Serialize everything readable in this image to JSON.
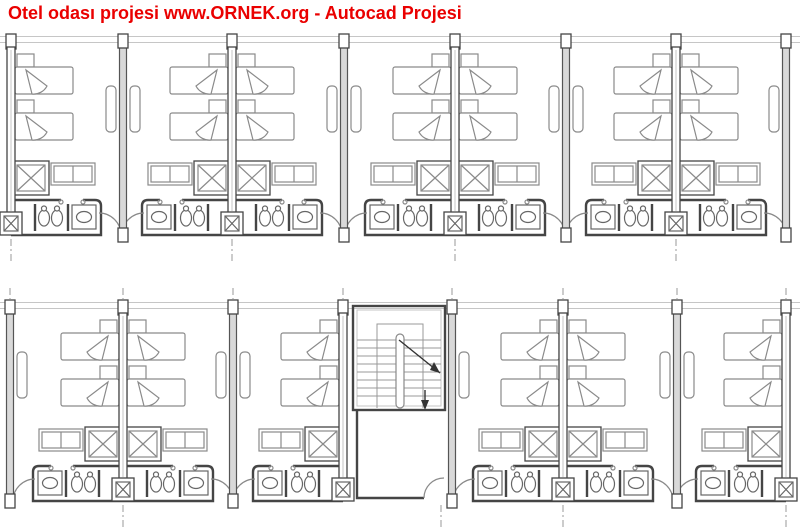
{
  "page": {
    "title": "Otel odası projesi www.ORNEK.org - Autocad Projesi",
    "background": "#ffffff"
  },
  "colors": {
    "title_red": "#ea0000",
    "wall_dark": "#454545",
    "furniture_gray": "#8a8a8a",
    "fixture_gray": "#666666",
    "light_gray": "#c6c6c6",
    "partition_fill": "#d9d9d9",
    "centerline_gray": "#9a9a9a",
    "stair_detail": "#999999"
  },
  "floorplan": {
    "drawing_type": "hotel-guestroom-floor-plan",
    "canvas": {
      "width": 800,
      "height": 532
    },
    "rows": [
      {
        "name": "upper-wing",
        "y": 42,
        "pairs": [
          {
            "x": 11,
            "rooms": [
              "right"
            ]
          },
          {
            "x": 232,
            "rooms": [
              "left",
              "right"
            ]
          },
          {
            "x": 455,
            "rooms": [
              "left",
              "right"
            ]
          },
          {
            "x": 676,
            "rooms": [
              "left",
              "right"
            ]
          }
        ],
        "partitions": [
          {
            "x": 123,
            "desks": [
              "left",
              "right"
            ]
          },
          {
            "x": 344,
            "desks": [
              "left",
              "right"
            ]
          },
          {
            "x": 566,
            "desks": [
              "left",
              "right"
            ]
          },
          {
            "x": 786,
            "desks": [
              "left"
            ]
          }
        ],
        "centerlines_above": [],
        "centerlines_below": [
          11,
          232,
          455,
          676
        ]
      },
      {
        "name": "lower-wing",
        "y": 308,
        "pairs": [
          {
            "x": 123,
            "rooms": [
              "left",
              "right"
            ]
          },
          {
            "x": 343,
            "rooms": [
              "left"
            ]
          },
          {
            "x": 563,
            "rooms": [
              "left",
              "right"
            ]
          },
          {
            "x": 786,
            "rooms": [
              "left"
            ]
          }
        ],
        "partitions": [
          {
            "x": 10,
            "desks": [
              "right"
            ]
          },
          {
            "x": 233,
            "desks": [
              "left",
              "right"
            ]
          },
          {
            "x": 452,
            "desks": [
              "right"
            ]
          },
          {
            "x": 677,
            "desks": [
              "left",
              "right"
            ]
          }
        ],
        "centerlines_above": [
          10,
          123,
          233,
          343,
          452,
          563,
          677,
          786
        ],
        "centerlines_below": [
          123,
          441,
          563,
          786
        ]
      }
    ],
    "room_counts": {
      "upper_wing_rooms": 7,
      "lower_wing_rooms": 6
    },
    "stair": {
      "x": 353,
      "y": 306,
      "width": 92,
      "height": 104,
      "treads": 8
    }
  }
}
